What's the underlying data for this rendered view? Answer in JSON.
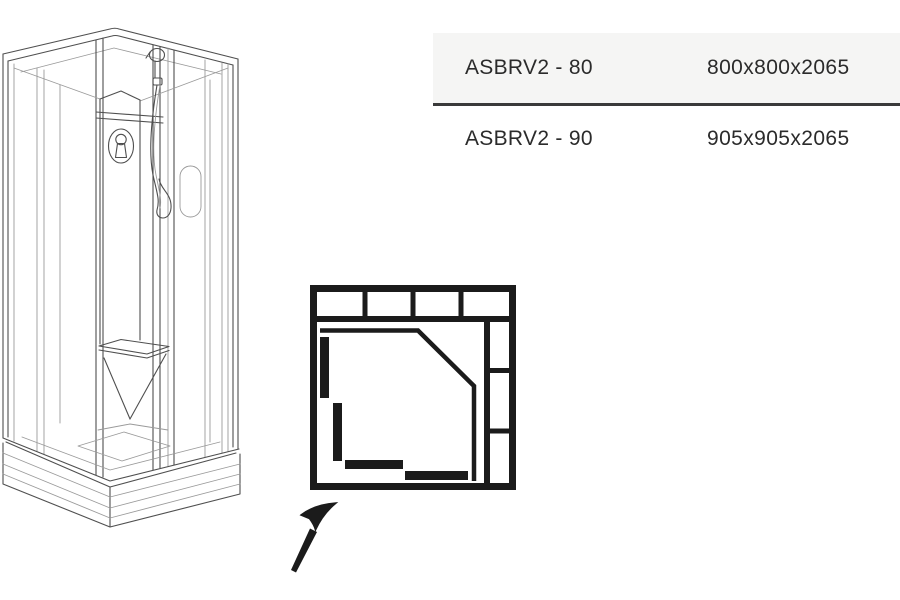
{
  "spec_table": {
    "rows": [
      {
        "model": "ASBRV2 - 80",
        "dimensions": "800x800x2065"
      },
      {
        "model": "ASBRV2 - 90",
        "dimensions": "905x905x2065"
      }
    ]
  },
  "figures": {
    "cabin": "corner shower cabin isometric line drawing",
    "top_view": "square top-view layout schematic with sliding door panels",
    "arrow": "hand-drawn arrow pointing to corner entry"
  },
  "colors": {
    "drawing_line": "#4f4f4f",
    "drawing_line_light": "#9a9a9a",
    "diagram_ink": "#1b1b1b",
    "row_stripe_bg": "#f5f5f4",
    "table_rule": "#3a3a3a",
    "table_text": "#2b2b2b"
  }
}
